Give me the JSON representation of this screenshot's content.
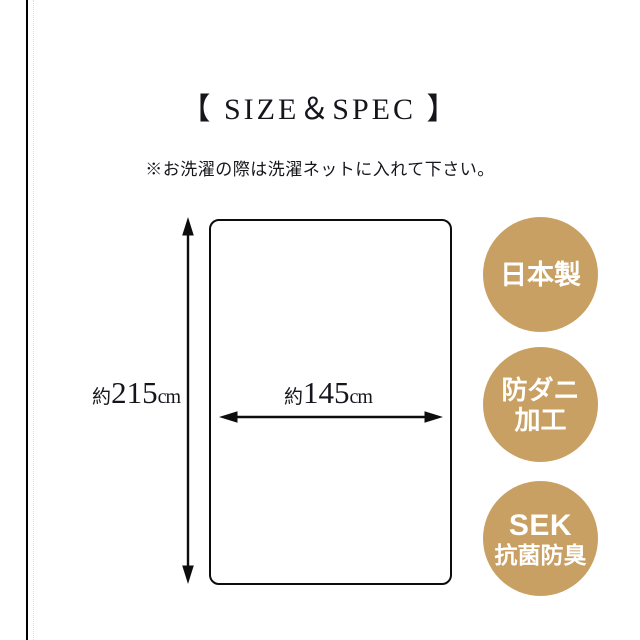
{
  "page": {
    "title": "【 SIZE＆SPEC 】",
    "note": "※お洗濯の際は洗濯ネットに入れて下さい。"
  },
  "diagram": {
    "height_label": {
      "prefix": "約",
      "value": "215",
      "unit": "cm"
    },
    "width_label": {
      "prefix": "約",
      "value": "145",
      "unit": "cm"
    }
  },
  "badges": [
    {
      "lines": [
        "日本製"
      ]
    },
    {
      "lines": [
        "防ダニ",
        "加工"
      ]
    },
    {
      "lines": [
        "SEK",
        "抗菌防臭"
      ]
    }
  ],
  "colors": {
    "badge_background": "#C9A063",
    "badge_text": "#FFFFFF",
    "line_color": "#0D0D0D"
  }
}
